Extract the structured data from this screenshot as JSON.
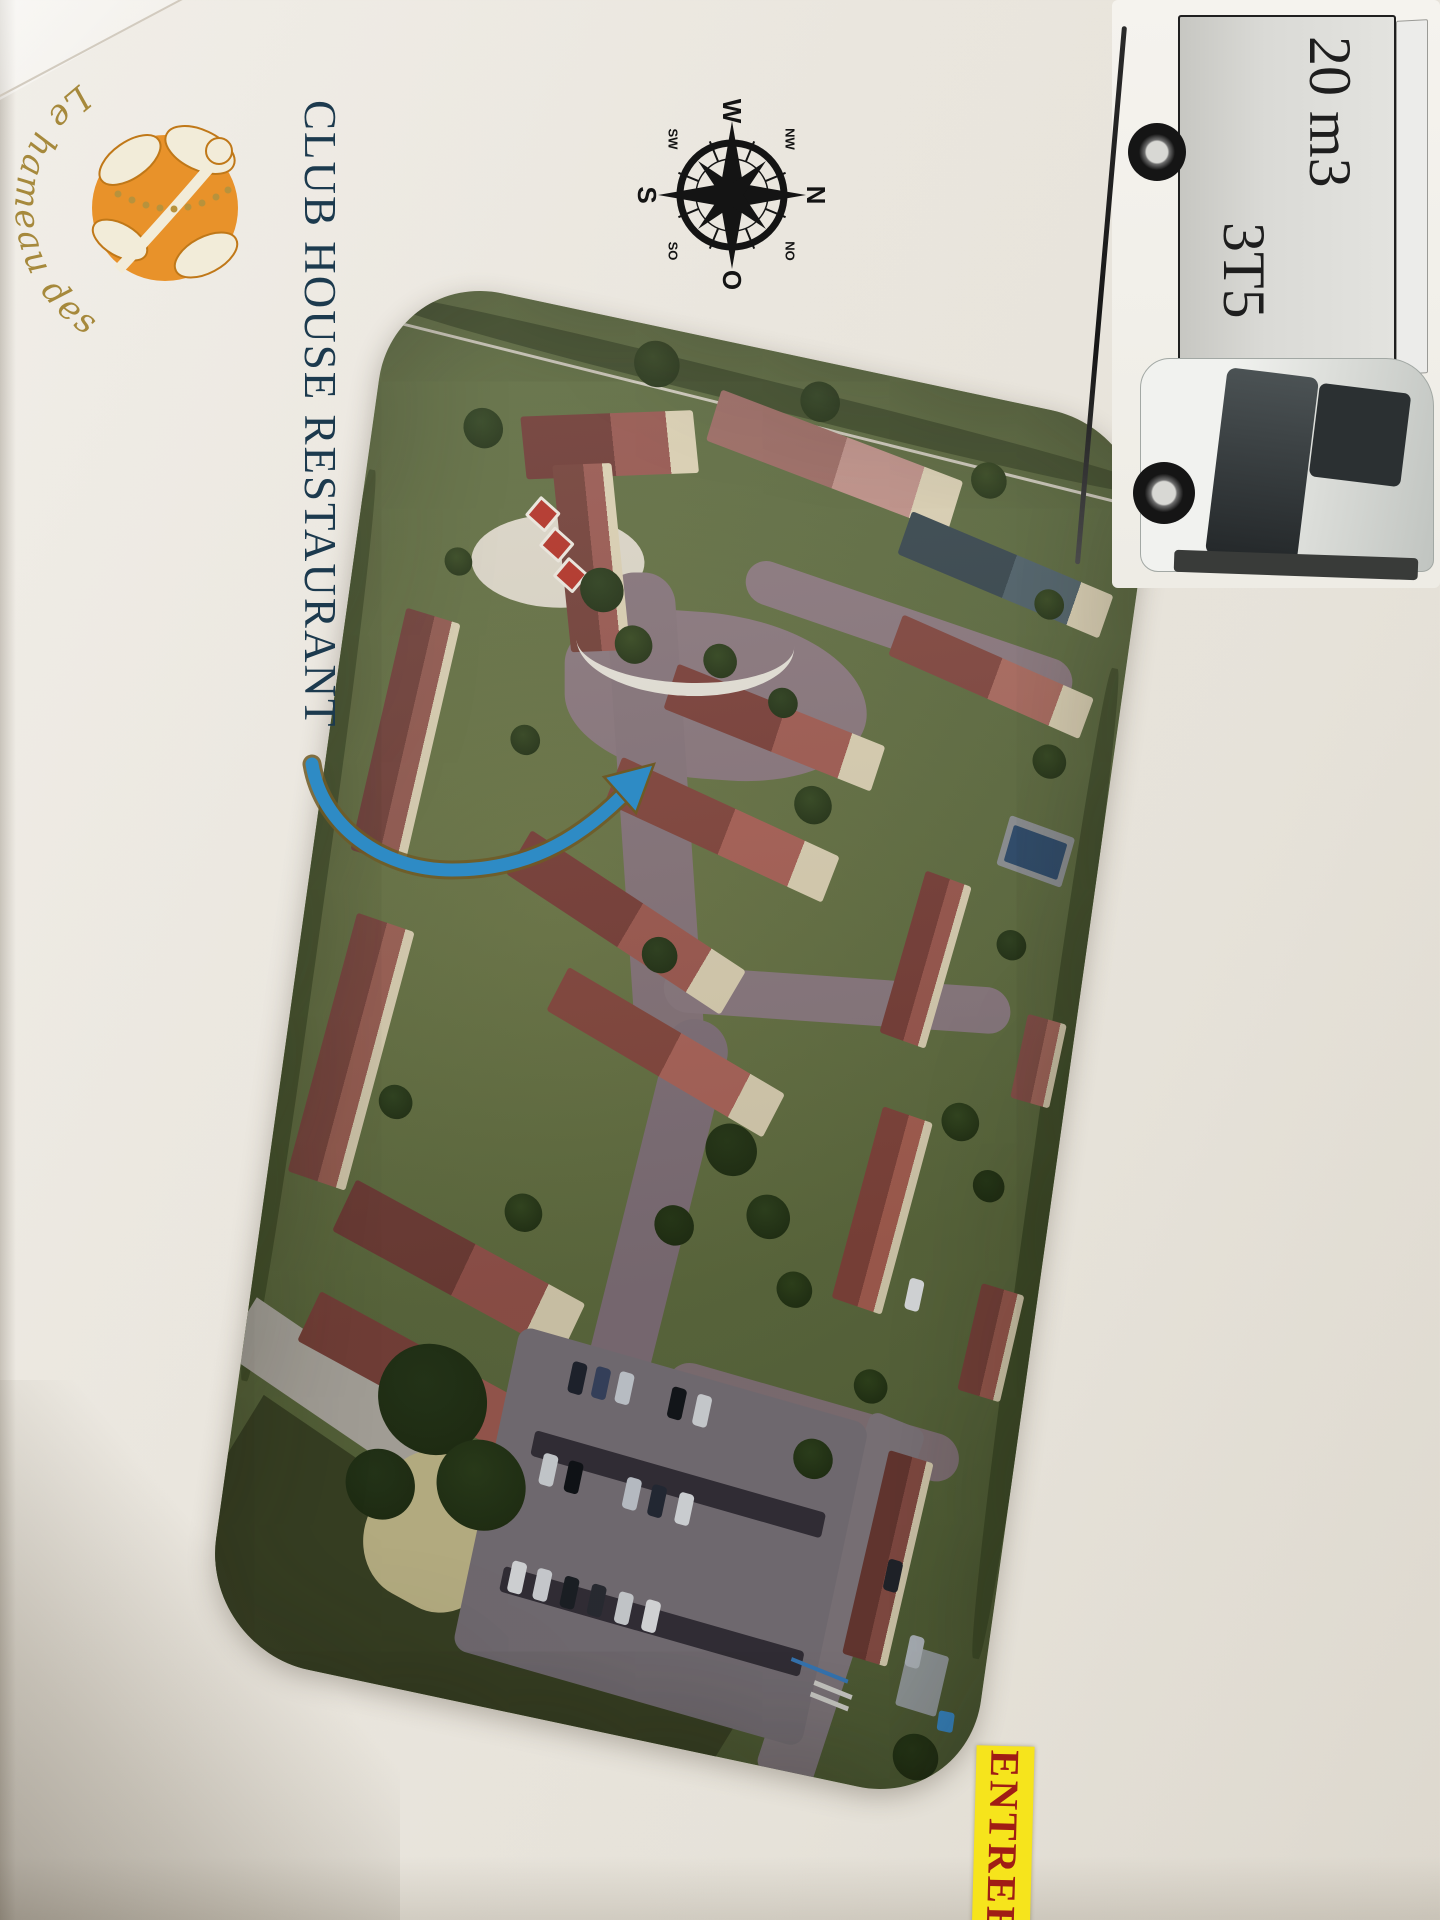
{
  "logo": {
    "label": "Le hameau des Fées"
  },
  "heading": {
    "label": "CLUB HOUSE RESTAURANT"
  },
  "compass": {
    "n": "N",
    "o": "O",
    "s": "S",
    "w": "W",
    "no": "NO",
    "so": "SO",
    "sw": "SW",
    "nw": "NW"
  },
  "truck": {
    "volume": "20 m3",
    "tonnage": "3T5"
  },
  "entrance_sign": {
    "label": "ENTREE R"
  },
  "colors": {
    "logo_orange": "#e8922a",
    "logo_gold": "#a6893c",
    "heading_navy": "#1c3a4e",
    "arrow_blue": "#2e8bc5",
    "sign_yellow": "#f6e41c",
    "sign_red": "#a01d15"
  }
}
